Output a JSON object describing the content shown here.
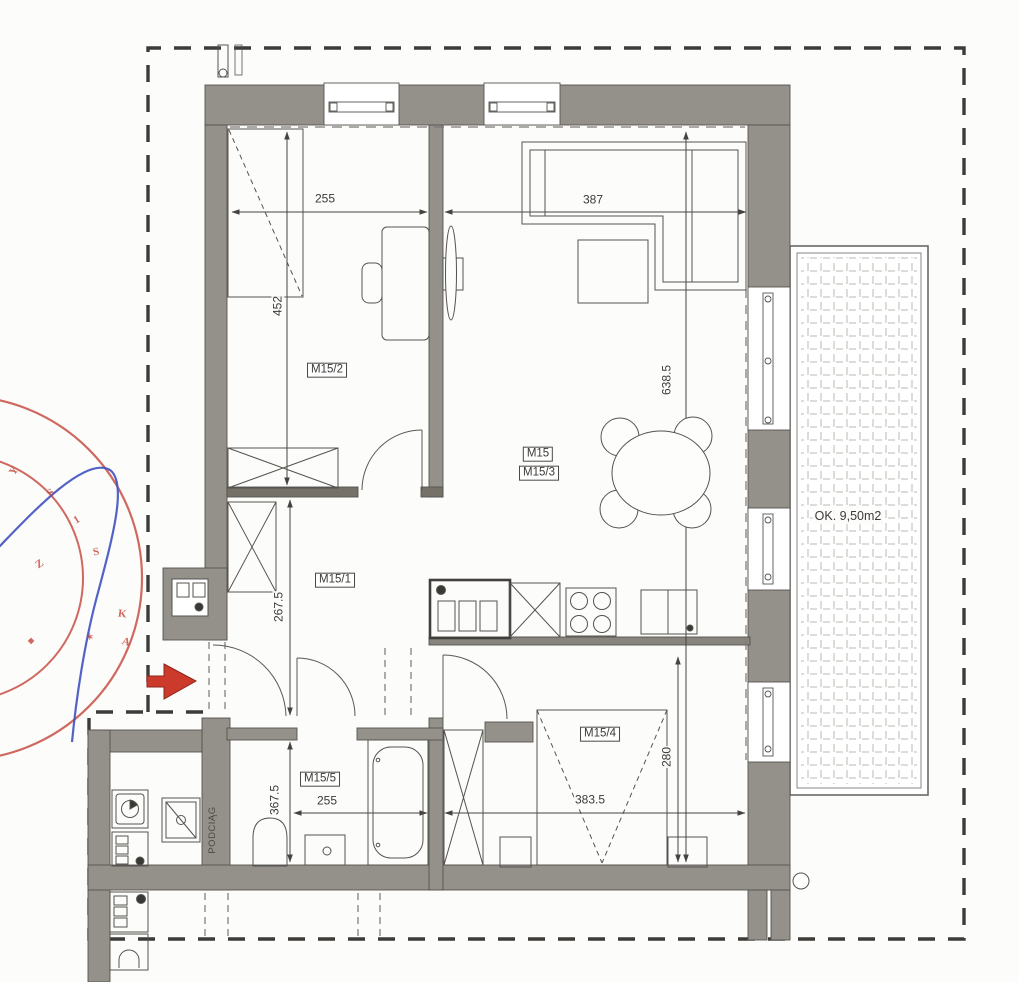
{
  "plan": {
    "rooms": {
      "m15_2": "M15/2",
      "m15": "M15",
      "m15_3": "M15/3",
      "m15_1": "M15/1",
      "m15_4": "M15/4",
      "m15_5": "M15/5"
    },
    "dimensions": {
      "bedroom2_width": "255",
      "living_width": "387",
      "bedroom2_height": "452",
      "living_height": "638.5",
      "hall_height": "267.5",
      "bath_height": "367.5",
      "bath_width": "255",
      "bedroom1_width": "383.5",
      "bedroom1_height": "280"
    },
    "balcony_label": "OK. 9,50m2",
    "beam_label": "PODCIĄG",
    "stamp_glyphs": [
      "Y",
      "S",
      "1",
      "S",
      "Z",
      "K",
      "A",
      "✶",
      "◆"
    ],
    "colors": {
      "wall": "#94908a",
      "line": "#55534e",
      "stamp_red": "#c4453a",
      "arrow_red": "#cc3a2c",
      "signature_blue": "#3f51c0"
    }
  }
}
